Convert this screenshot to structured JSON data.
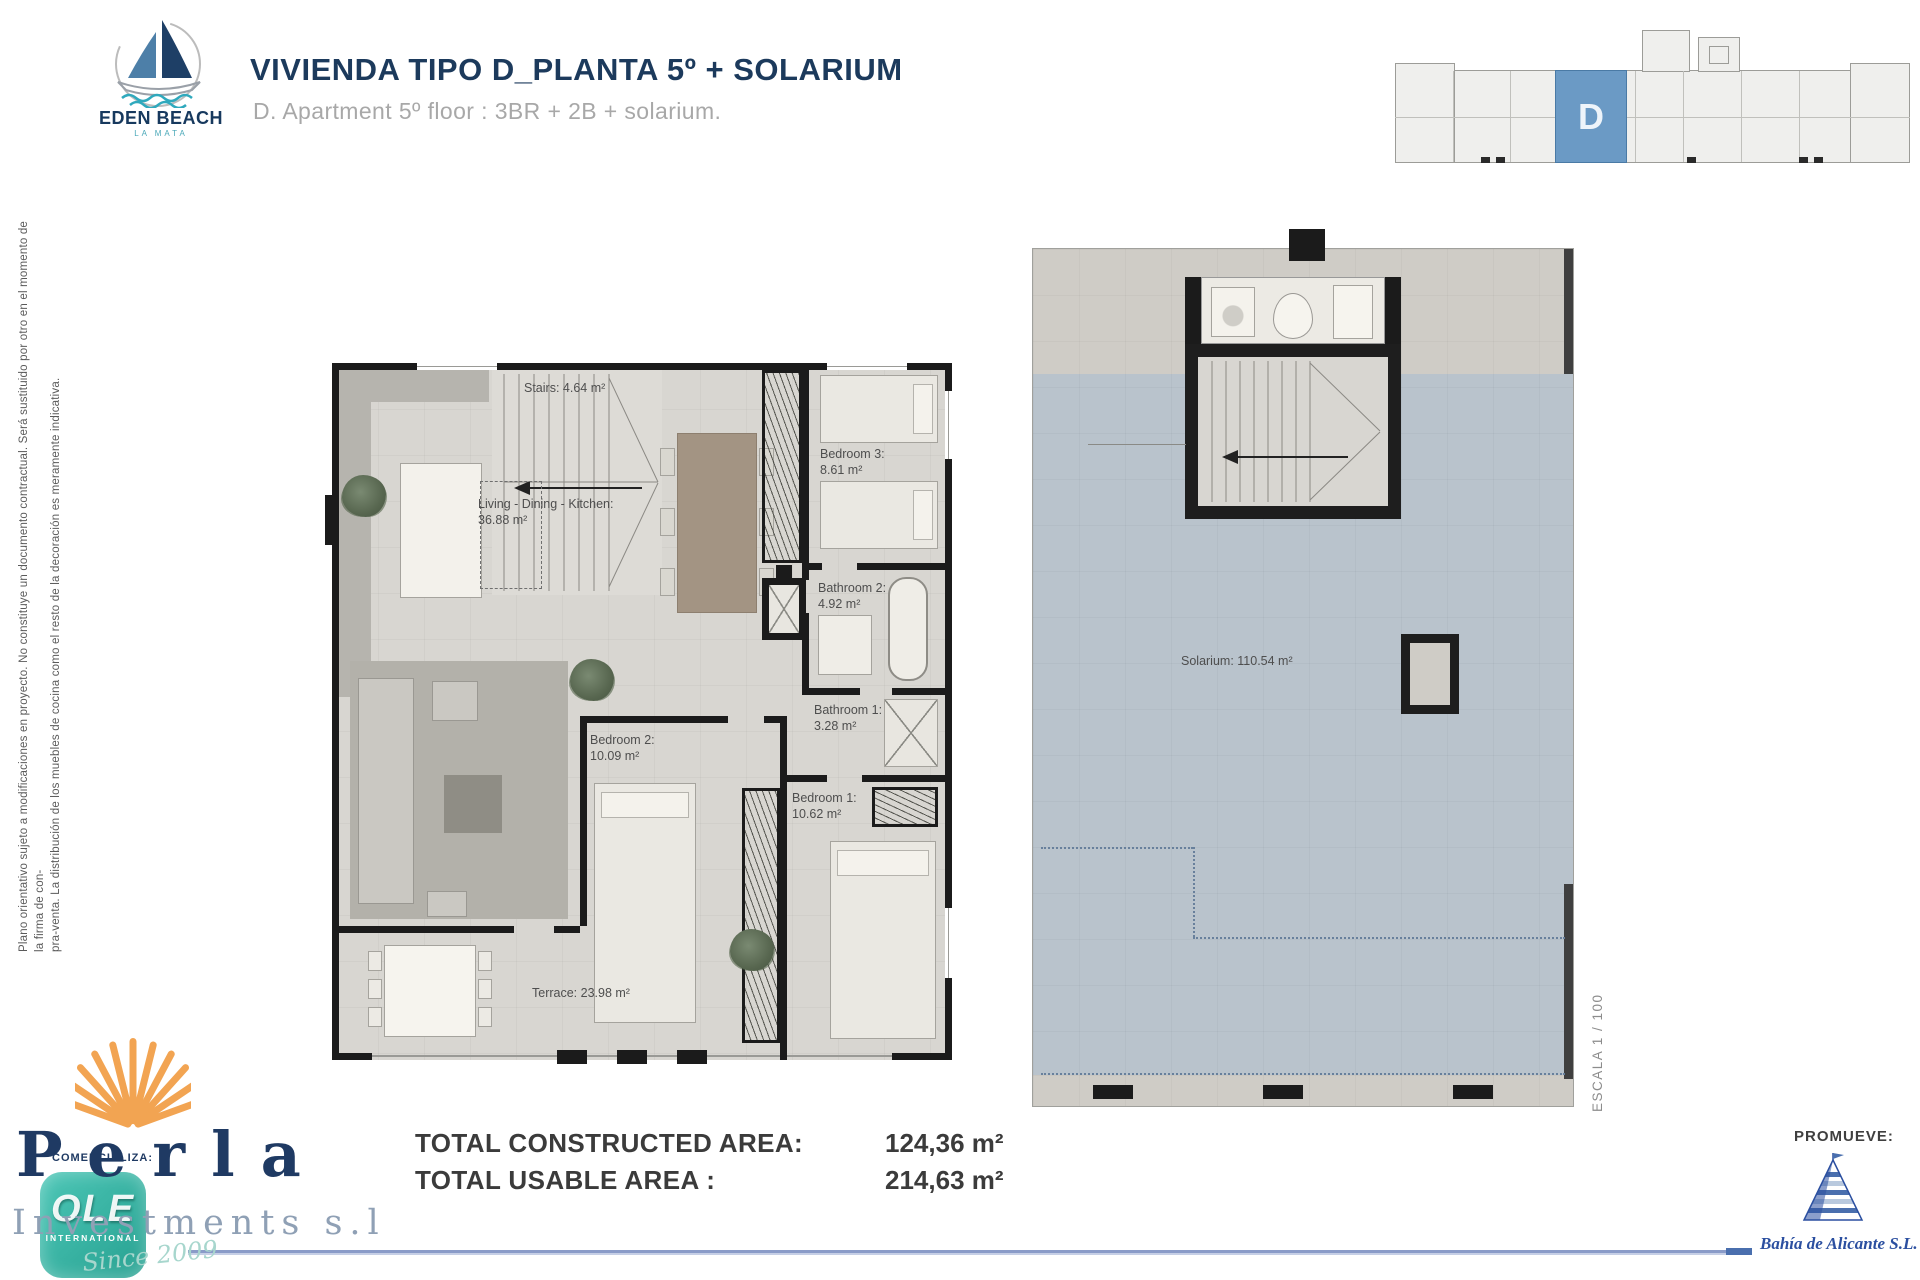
{
  "header": {
    "brand": {
      "name": "EDEN BEACH",
      "tagline": "LA MATA"
    },
    "title": {
      "pre": "VIVIENDA TIPO ",
      "unit": "D",
      "post": "_PLANTA 5º + SOLARIUM"
    },
    "subtitle": "D. Apartment 5º floor : 3BR + 2B + solarium."
  },
  "key_plan": {
    "unit_label": "D"
  },
  "disclaimer": {
    "line1": "Plano orientativo sujeto a modificaciones en proyecto. No constituye un documento contractual. Será sustituido por otro en el momento de la firma de con-",
    "line2": "pra-venta. La distribución de los muebles de cocina como el resto de la decoración es meramente indicativa."
  },
  "apartment_plan": {
    "rooms": {
      "stairs": {
        "label": "Stairs: 4.64 m²"
      },
      "living": {
        "name": "Living - Dining - Kitchen:",
        "area": "36.88 m²"
      },
      "bedroom3": {
        "name": "Bedroom 3:",
        "area": "8.61 m²"
      },
      "bathroom2": {
        "name": "Bathroom 2:",
        "area": "4.92 m²"
      },
      "bathroom1": {
        "name": "Bathroom 1:",
        "area": "3.28 m²"
      },
      "bedroom2": {
        "name": "Bedroom 2:",
        "area": "10.09 m²"
      },
      "bedroom1": {
        "name": "Bedroom 1:",
        "area": "10.62 m²"
      },
      "terrace": {
        "label": "Terrace: 23.98 m²"
      }
    }
  },
  "solarium_plan": {
    "label": "Solarium: 110.54 m²",
    "scale": "ESCALA 1 / 100"
  },
  "totals": {
    "rows": [
      {
        "label": "TOTAL CONSTRUCTED AREA:",
        "value": "124,36 m²"
      },
      {
        "label": "TOTAL USABLE AREA :",
        "value": "214,63 m²"
      }
    ]
  },
  "commercializer": {
    "caption": "COMERCIALIZA:",
    "brand": "Perla",
    "brand_sub": "Investments s.l",
    "badge": {
      "title": "OLE",
      "subtitle": "INTERNATIONAL",
      "since": "Since 2009"
    }
  },
  "developer": {
    "caption": "PROMUEVE:",
    "company": "Bahía de Alicante S.L."
  }
}
